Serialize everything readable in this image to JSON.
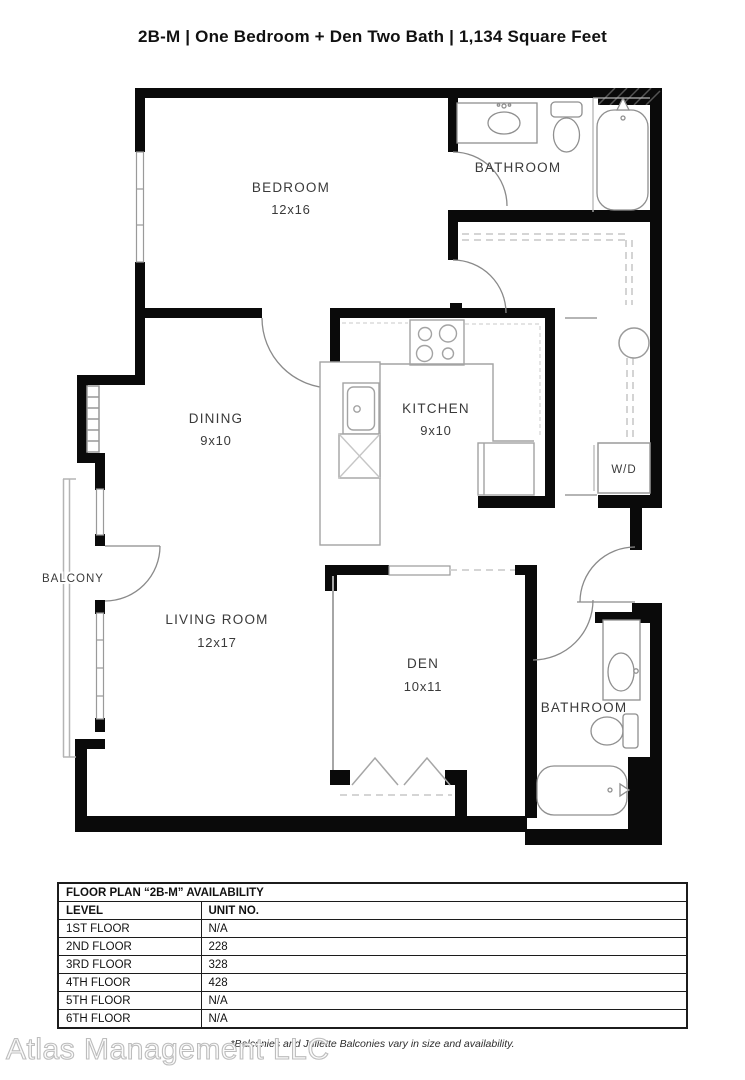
{
  "title": "2B-M | One Bedroom + Den Two Bath | 1,134  Square Feet",
  "floor_plan": {
    "rooms": {
      "bedroom": {
        "label": "BEDROOM",
        "dims": "12x16"
      },
      "bath_upper": {
        "label": "BATHROOM"
      },
      "dining": {
        "label": "DINING",
        "dims": "9x10"
      },
      "kitchen": {
        "label": "KITCHEN",
        "dims": "9x10"
      },
      "wd": {
        "label": "W/D"
      },
      "balcony": {
        "label": "BALCONY"
      },
      "living": {
        "label": "LIVING ROOM",
        "dims": "12x17"
      },
      "den": {
        "label": "DEN",
        "dims": "10x11"
      },
      "bath_lower": {
        "label": "BATHROOM"
      }
    }
  },
  "availability_table": {
    "title": "FLOOR PLAN “2B-M” AVAILABILITY",
    "columns": [
      "LEVEL",
      "UNIT NO."
    ],
    "rows": [
      {
        "level": "1ST FLOOR",
        "unit": "N/A"
      },
      {
        "level": "2ND FLOOR",
        "unit": "228"
      },
      {
        "level": "3RD FLOOR",
        "unit": "328"
      },
      {
        "level": "4TH FLOOR",
        "unit": "428"
      },
      {
        "level": "5TH FLOOR",
        "unit": "N/A"
      },
      {
        "level": "6TH FLOOR",
        "unit": "N/A"
      }
    ]
  },
  "footnote": "*Balconies and Juliette Balconies vary in size and availability.",
  "watermark": "Atlas Management LLC",
  "colors": {
    "wall": "#0a0a0a",
    "fixture": "#8f8f8f",
    "dash": "#cfcfcf",
    "label": "#3a3a3a"
  }
}
